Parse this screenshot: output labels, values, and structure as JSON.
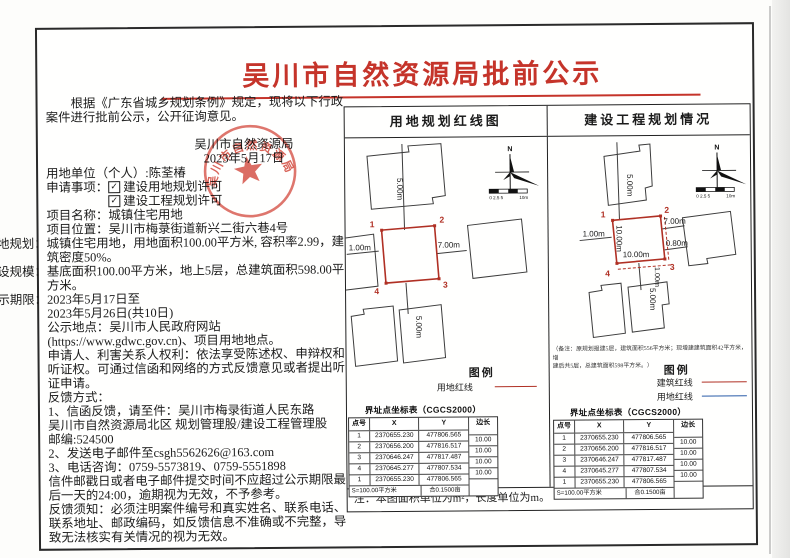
{
  "title": "吴川市自然资源局批前公示",
  "intro": "根据《广东省城乡规划条例》规定，现将以下行政案件进行批前公示，公开征询意见。",
  "issuer": {
    "name": "吴川市自然资源局",
    "date": "2023年5月17日",
    "seal_text": "吴川市自然资源局"
  },
  "icons": {
    "check": "✓"
  },
  "fields": {
    "unit": {
      "label": "用地单位（个人）",
      "value": ":陈荃椿"
    },
    "apply": {
      "label": "申请事项：",
      "item1": "建设用地规划许可",
      "item2": "建设工程规划许可"
    },
    "name": {
      "label": "项目名称：",
      "value": "城镇住宅用地"
    },
    "location": {
      "label": "项目位置：",
      "value": "吴川市梅菉街道新兴二街六巷4号"
    },
    "planning": {
      "label": "用地规划：",
      "value": "城镇住宅用地，用地面积100.00平方米, 容积率2.99，建筑密度50%。"
    },
    "scale": {
      "label": "建设规模：",
      "value": "基底面积100.00平方米，地上5层，总建筑面积598.00平方米。"
    },
    "period": {
      "label": "公示期限：",
      "value": "2023年5月17日至",
      "value2": "2023年5月26日(共10日)"
    },
    "place": {
      "label": "公示地点：",
      "value": "吴川市人民政府网站",
      "value2": "(https://www.gdwc.gov.cn)、项目用地地点。"
    }
  },
  "rights": "申请人、利害关系人权利：依法享受陈述权、申辩权和听证权。可通过信函和网络的方式反馈意见或者提出听证申请。",
  "feedback": {
    "heading": "反馈方式：",
    "line1": "1、信函反馈，请至件：吴川市梅录街道人民东路",
    "line2": "吴川市自然资源局北区  规划管理股/建设工程管理股",
    "line3": "邮编:524500",
    "line4": "2、发送电子邮件至csgh5562626@163.com",
    "line5": "3、电话咨询：0759-5573819、0759-5551898",
    "line6": "信件邮戳日或者电子邮件提交时间不应超过公示期限最后一天的24:00，逾期视为无效，不予参考。",
    "line7": "反馈须知：必须注明案件编号和真实姓名、联系电话、联系地址、邮政编码，如反馈信息不准确或不完整，导致无法核实有关情况的视为无效。"
  },
  "panels": {
    "left_header": "用地规划红线图",
    "right_header": "建设工程规划情况",
    "note": "注：本图面积单位为m²，长度单位为m。",
    "legend_title": "图例",
    "legend_land": "用地红线",
    "legend_building": "建筑红线",
    "remark_line1": "（备注：原规划报建5层，建筑面积556平方米；现增建建筑面积42平方米，增",
    "remark_line2": "建后共5层，总建筑面积598平方米。）"
  },
  "diagram": {
    "north_label": "N",
    "scale_left": "0 2.5 5",
    "scale_right": "10m",
    "points": {
      "p1": "1",
      "p2": "2",
      "p3": "3",
      "p4": "4"
    },
    "dims": {
      "d500": "5.00m",
      "d100": "1.00m",
      "d700": "7.00m",
      "d080": "0.80m",
      "d1000": "10.00m"
    }
  },
  "coord_table": {
    "title": "界址点坐标表（CGCS2000）",
    "col_point": "点号",
    "col_x": "X",
    "col_y": "Y",
    "col_len": "边长",
    "rows": [
      {
        "pt": "1",
        "x": "2370655.230",
        "y": "477806.565"
      },
      {
        "pt": "2",
        "x": "2370656.200",
        "y": "477816.517"
      },
      {
        "pt": "3",
        "x": "2370646.247",
        "y": "477817.487"
      },
      {
        "pt": "4",
        "x": "2370645.277",
        "y": "477807.534"
      },
      {
        "pt": "1",
        "x": "2370655.230",
        "y": "477806.565"
      }
    ],
    "lens": [
      "10.00",
      "10.00",
      "10.00",
      "10.00"
    ],
    "area": "S=100.00平方米",
    "mu": "合0.1500亩"
  }
}
